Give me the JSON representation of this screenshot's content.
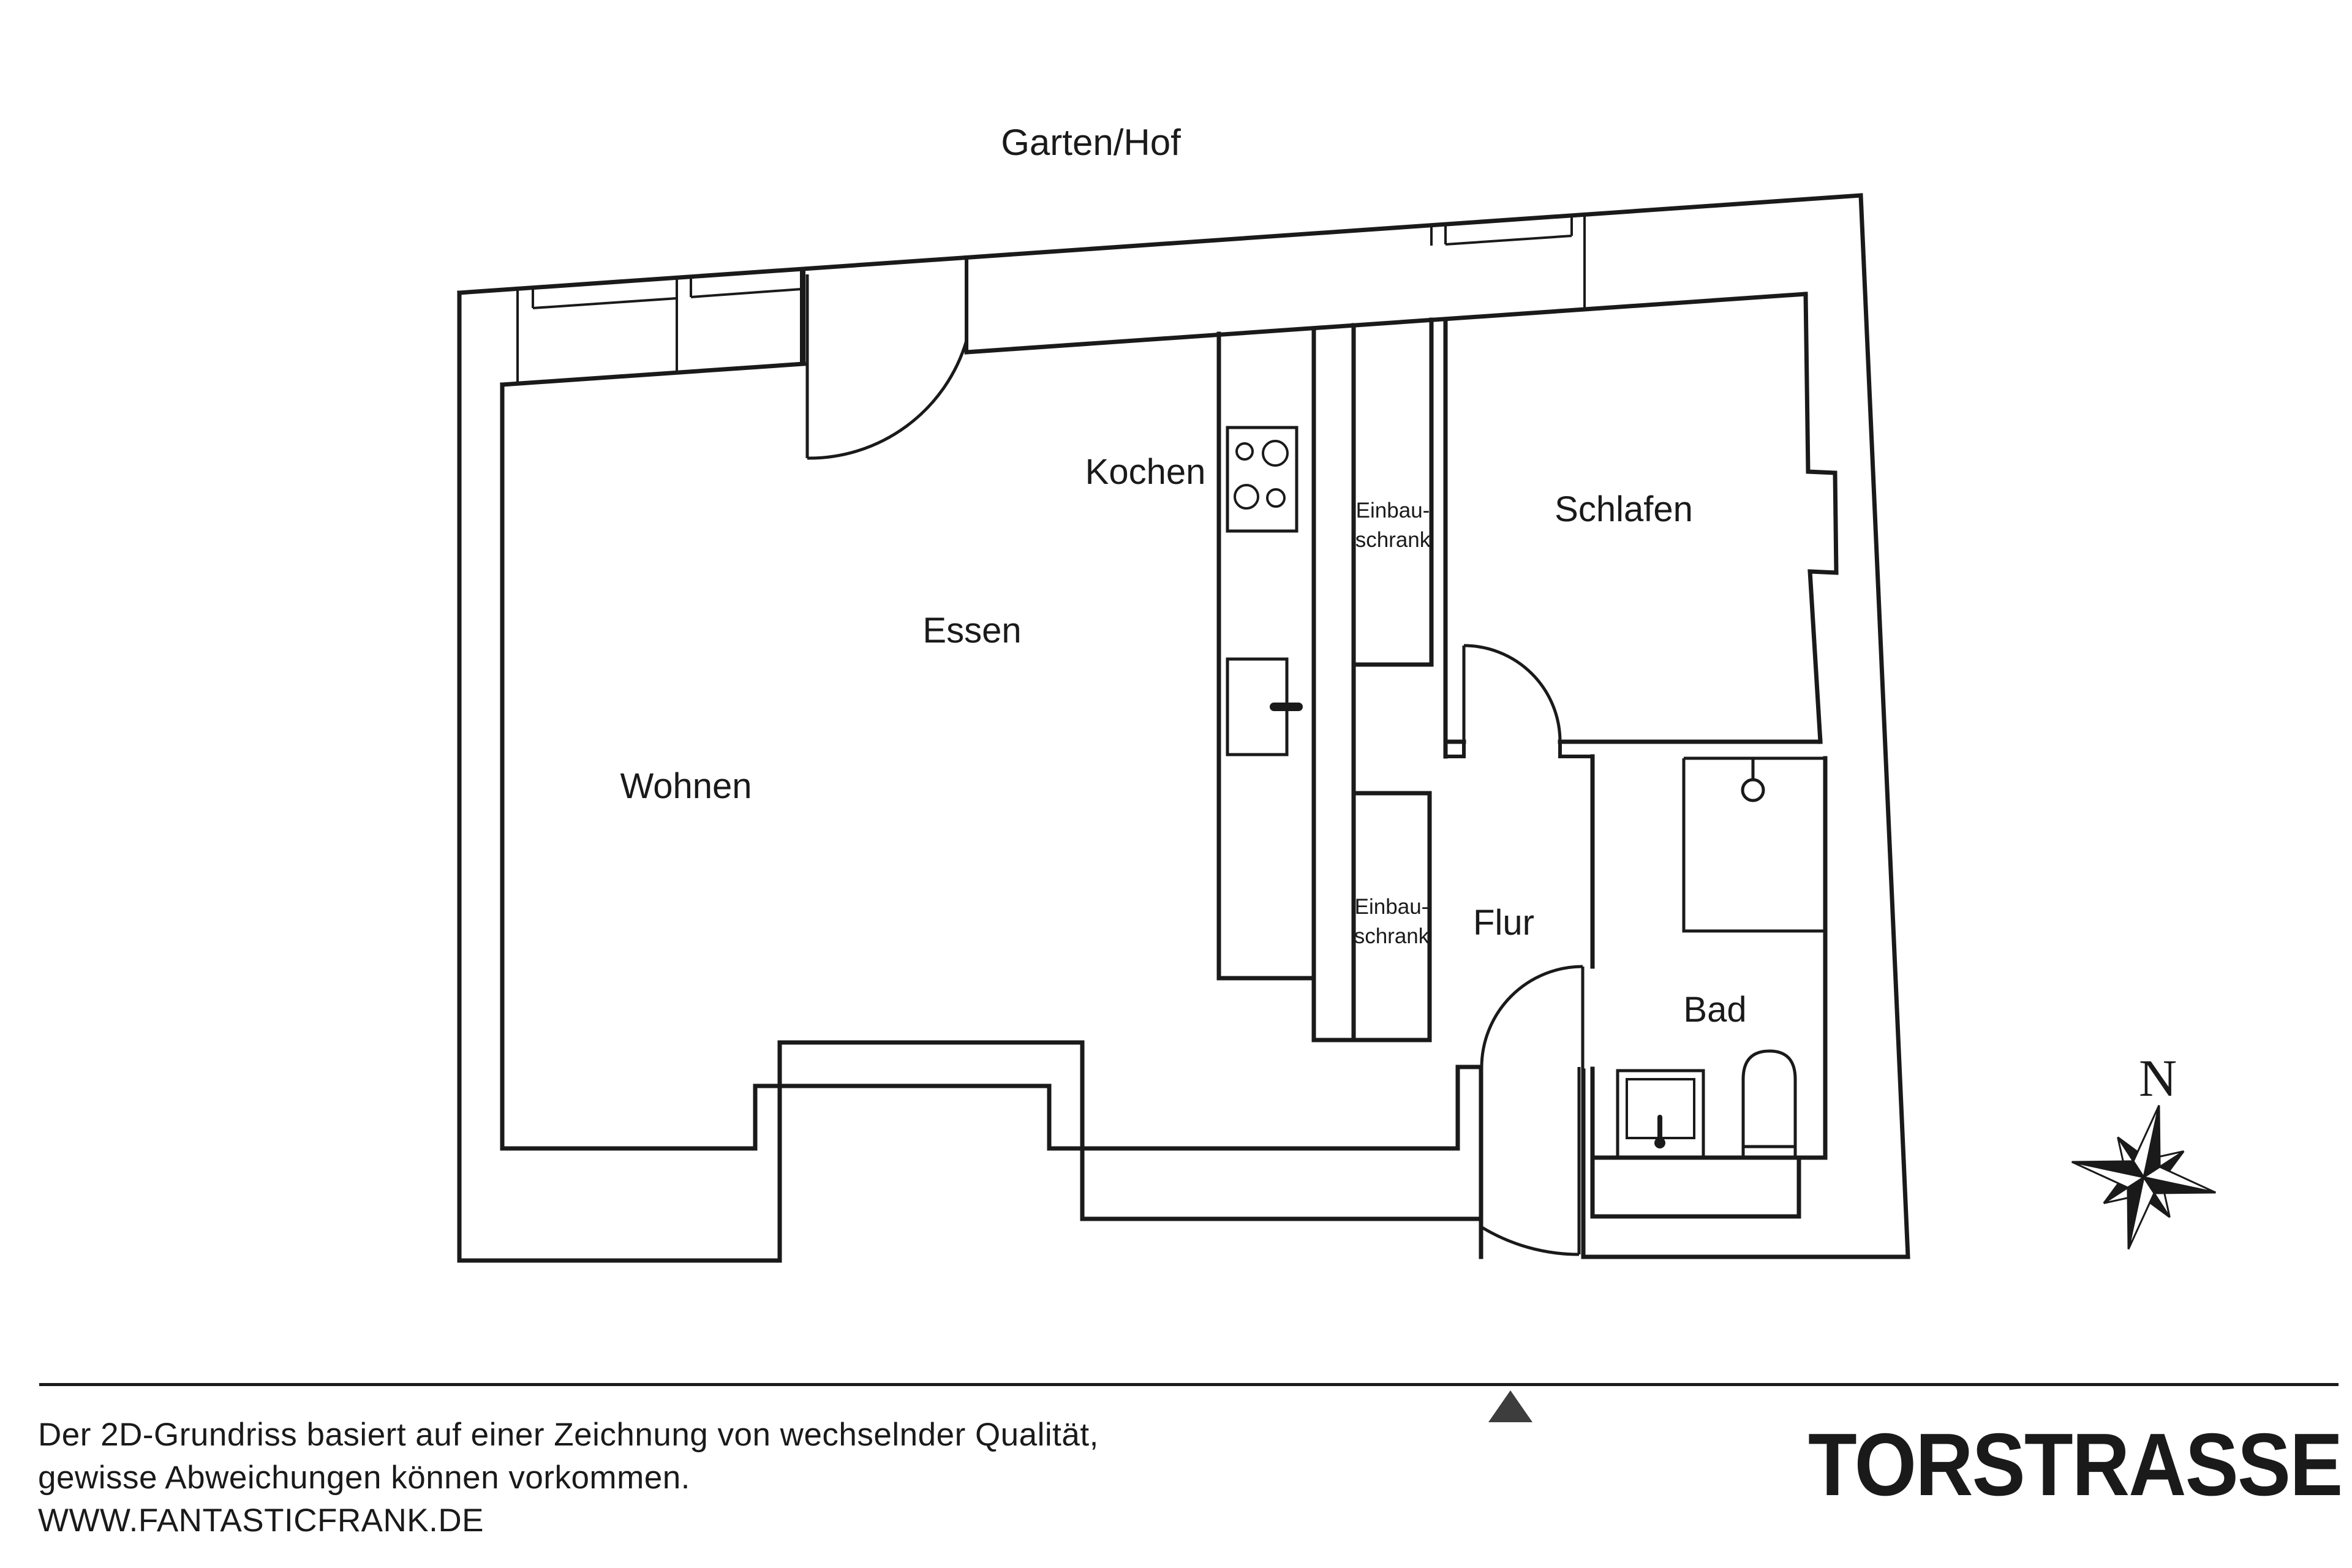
{
  "plan": {
    "outdoor_label": "Garten/Hof",
    "rooms": {
      "wohnen": "Wohnen",
      "essen": "Essen",
      "kochen": "Kochen",
      "schlafen": "Schlafen",
      "flur": "Flur",
      "bad": "Bad"
    },
    "closets": {
      "line1": "Einbau-",
      "line2": "schrank"
    },
    "compass": {
      "north": "N"
    }
  },
  "footer": {
    "disclaimer_line1": "Der 2D-Grundriss basiert auf einer Zeichnung von wechselnder Qualität,",
    "disclaimer_line2": "gewisse Abweichungen können vorkommen.",
    "website": "WWW.FANTASTICFRANK.DE",
    "street_name": "TORSTRASSE"
  },
  "colors": {
    "line": "#1a1a1a",
    "text": "#1a1a1a",
    "marker": "#3d3d3d",
    "background": "#ffffff"
  }
}
